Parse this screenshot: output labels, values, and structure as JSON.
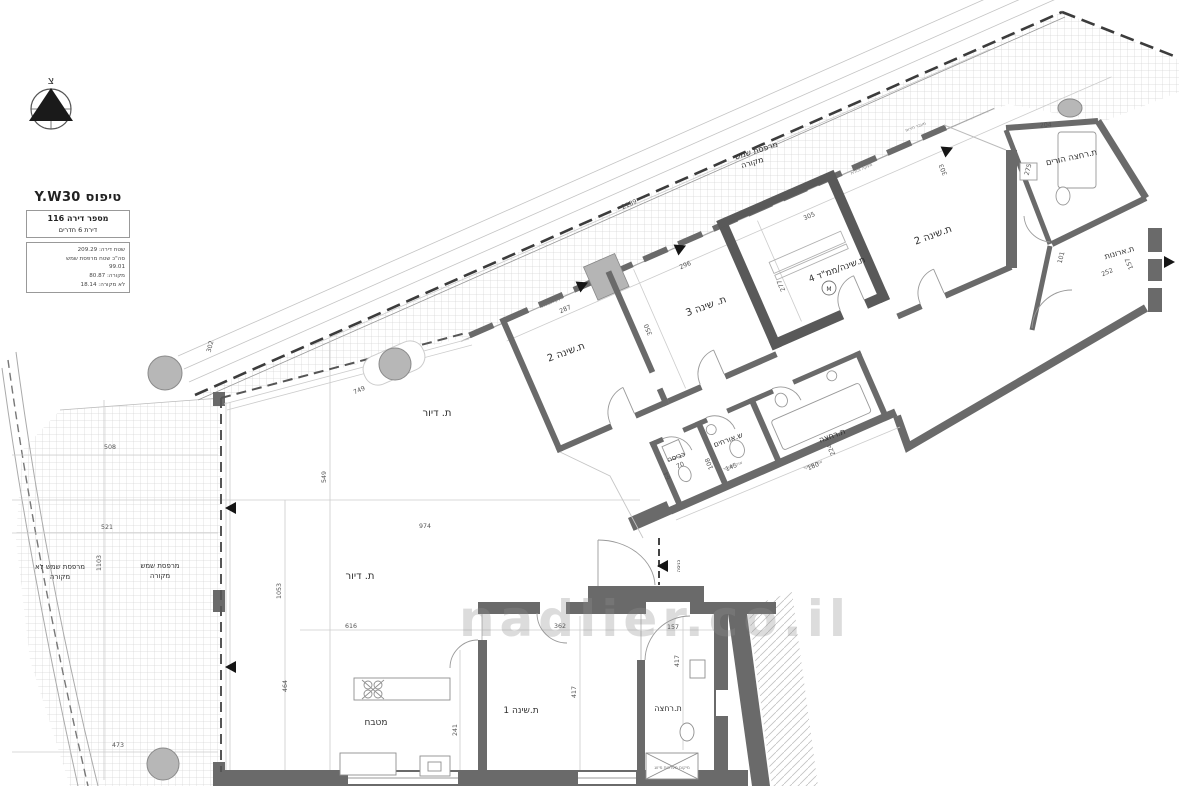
{
  "document": {
    "type_title": "טיפוס Y.W30",
    "apartment_number_line": "מספר דירה 116",
    "rooms_line": "דירת 6 חדרים",
    "area_lines": [
      "שטח דירה: 209.29",
      "סה\"כ שטח מרפסת שמש",
      "99.01",
      "מקורה: 80.87",
      "לא מקורה: 18.14"
    ]
  },
  "compass": {
    "north": "צ"
  },
  "watermark": "nadlier.co.il",
  "rooms": {
    "balcony_top": {
      "l1": "מרפסת שמש",
      "l2": "מקורה"
    },
    "bedroom2_mid": "ת.שינה 2",
    "bedroom3": "ת. שינה 3",
    "bedroom4_mamad": "ת.שינה/ממ\"ד 4",
    "bedroom2_tr": "ת.שינה 2",
    "parents_bath": "ת.רחצה הורים",
    "closets": "ת.ארונות",
    "living1": "ת. דיור",
    "living2": "ת. דיור",
    "laundry": "כביסה",
    "guest_wc": "ש.אורחים",
    "bath_mid": "ת.רחצה",
    "controlled_air": "אויר מבוקר",
    "kitchen": "מטבח",
    "bedroom1": "ת.שינה 1",
    "bath_bottom": "ת.רחצה",
    "entrance": "כניסה",
    "balcony_left_uncovered": {
      "l1": "מרפסת שמש לא",
      "l2": "מקורה"
    },
    "balcony_left_covered": {
      "l1": "מרפסת שמש",
      "l2": "מקורה"
    },
    "mamad_marker": "M"
  },
  "small_labels": {
    "railing": "מעקה זכוכית",
    "emergency": "מעבר חירום",
    "ac_note": "מיקום מערכות מיזוג"
  },
  "dims": [
    "2189",
    "287",
    "296",
    "305",
    "350",
    "277",
    "303",
    "204",
    "275",
    "252",
    "157",
    "101",
    "70",
    "64",
    "145",
    "108",
    "180",
    "224",
    "974",
    "549",
    "616",
    "1053",
    "749",
    "302",
    "508",
    "521",
    "1103",
    "473",
    "464",
    "362",
    "157",
    "417",
    "241",
    "417"
  ]
}
